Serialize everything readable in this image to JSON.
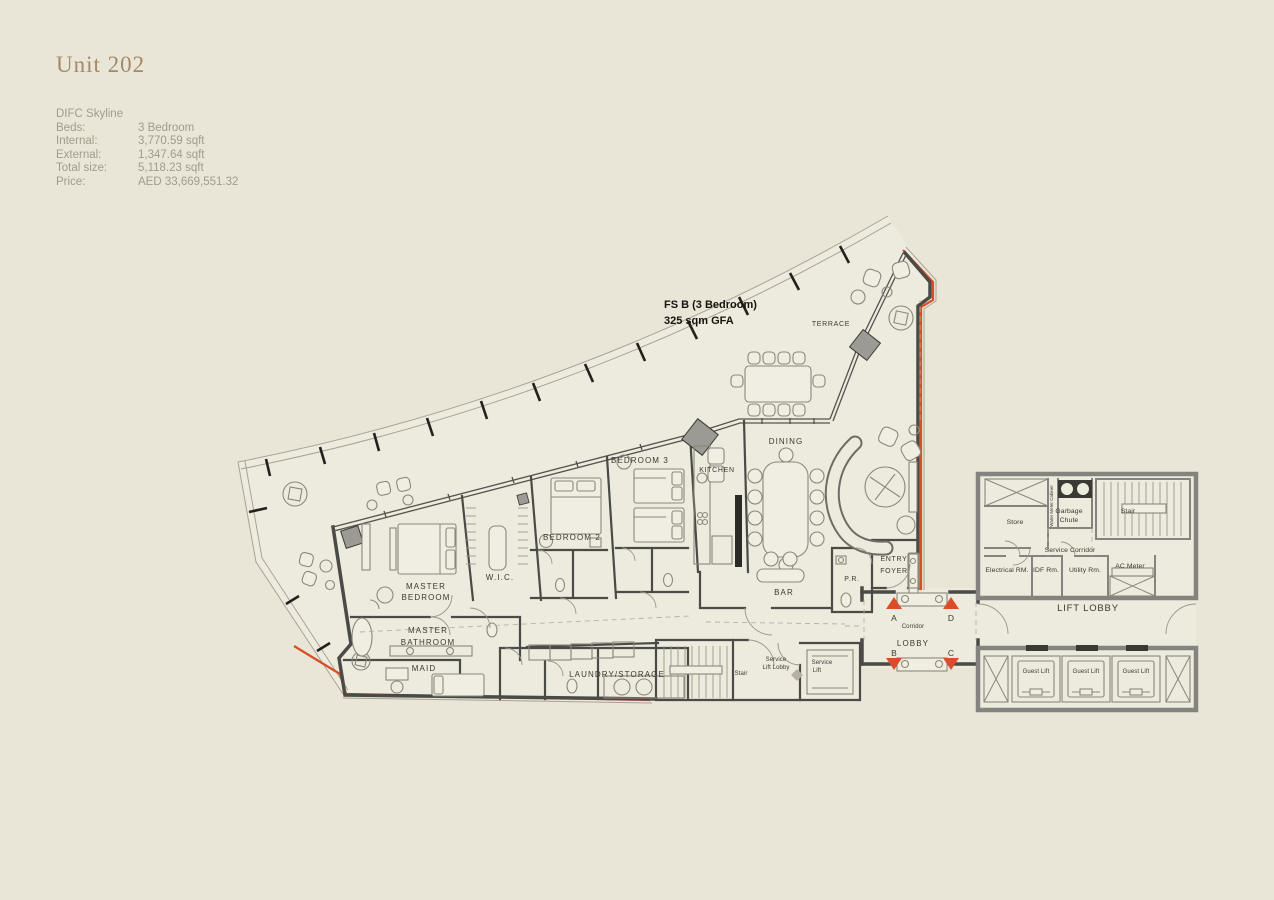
{
  "page": {
    "background": "#E9E6D8",
    "accent_red": "#D94E28"
  },
  "header": {
    "title": "Unit 202",
    "project": "DIFC Skyline",
    "fields": [
      {
        "label": "Beds:",
        "value": "3 Bedroom"
      },
      {
        "label": "Internal:",
        "value": "3,770.59 sqft"
      },
      {
        "label": "External:",
        "value": "1,347.64 sqft"
      },
      {
        "label": "Total size:",
        "value": "5,118.23 sqft"
      },
      {
        "label": "Price:",
        "value": "AED 33,669,551.32"
      }
    ]
  },
  "plan": {
    "annotation": {
      "line1": "FS B (3 Bedroom)",
      "line2": "325 sqm GFA"
    },
    "markers": {
      "a": "A",
      "b": "B",
      "c": "C",
      "d": "D"
    },
    "rooms": {
      "terrace": "TERRACE",
      "dining": "DINING",
      "kitchen": "KITCHEN",
      "bedroom3": "BEDROOM 3",
      "bedroom2": "BEDROOM 2",
      "master_bedroom": {
        "line1": "MASTER",
        "line2": "BEDROOM"
      },
      "wic": "W.I.C.",
      "master_bathroom": {
        "line1": "MASTER",
        "line2": "BATHROOM"
      },
      "maid": "MAID",
      "laundry": "LAUNDRY/STORAGE",
      "bar": "BAR",
      "pr": "P.R.",
      "entry_foyer": {
        "line1": "ENTRY",
        "line2": "FOYER"
      },
      "corridor": "Corridor",
      "lobby": "LOBBY",
      "stair_service": "Stair",
      "service_lift_lobby": {
        "line1": "Service",
        "line2": "Lift Lobby"
      },
      "service_lift": {
        "line1": "Service",
        "line2": "Lift"
      },
      "store": "Store",
      "garbage_chute": {
        "line1": "Garbage",
        "line2": "Chute"
      },
      "stair_core": "Stair",
      "water_meter": "Water Meter Cabinet",
      "service_corridor": "Service Corridor",
      "electrical": "Electrical RM.",
      "idf": "IDF Rm.",
      "utility": "Utility Rm.",
      "ac_meter": "AC Meter",
      "lift_lobby": "LIFT LOBBY",
      "guest_lift": "Guest Lift"
    }
  }
}
